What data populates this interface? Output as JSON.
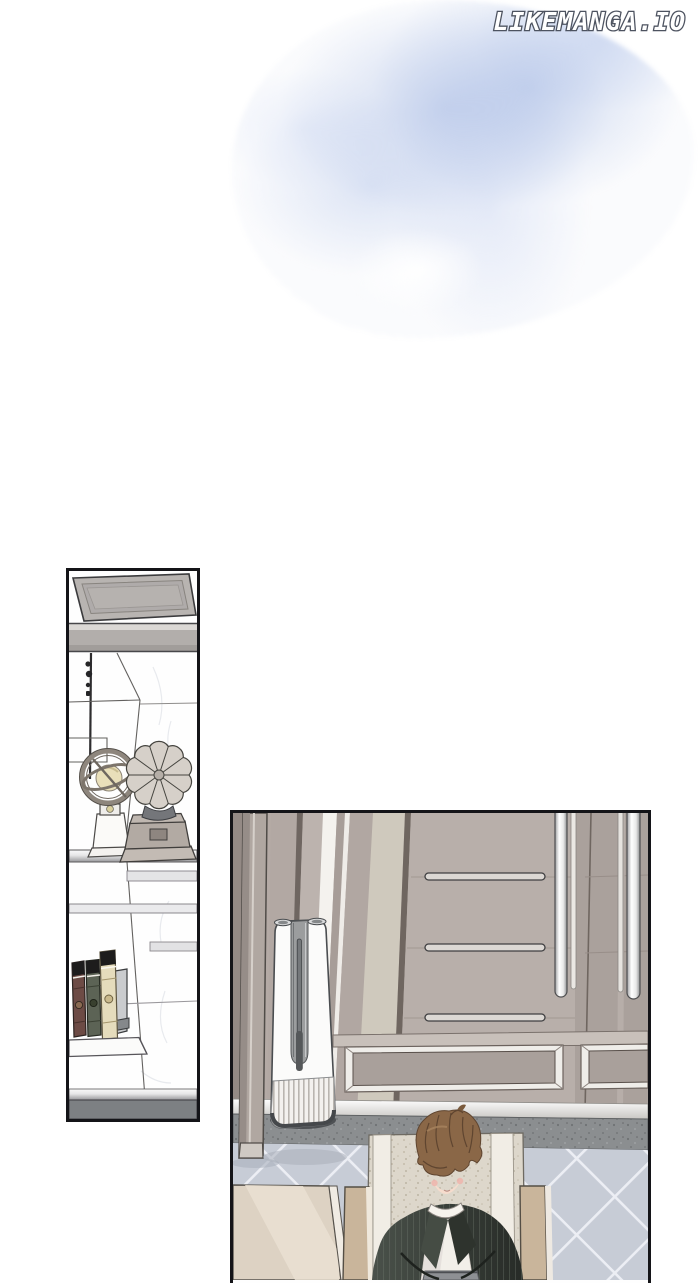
{
  "page": {
    "width": 700,
    "height": 1280,
    "background": "#ffffff"
  },
  "watermark": {
    "text": "LIKEMANGA.IO",
    "text_color": "#ffffff",
    "outline_color": "#4d5360"
  },
  "artwork": {
    "wash": {
      "type": "watercolor-texture",
      "position": "top-center",
      "colors": [
        "#a8bbe4",
        "#c7d3f0",
        "#ffffff"
      ]
    },
    "panels": [
      {
        "name": "bookshelf-panel",
        "border_color": "#141418",
        "items": [
          "cabinet-top-slab",
          "marble-shelves",
          "armillary-globe",
          "fan-ornament",
          "book-row",
          "bookend",
          "base-plinth"
        ],
        "palette": {
          "slab": "#b8b4b1",
          "shelf_silver": "#e8e8e8",
          "base_strip": "#7d8083",
          "book_spines": [
            "#6d4b45",
            "#5c6355",
            "#e5dcbc"
          ],
          "globe_sphere": "#e9dfba",
          "fan_body": "#d6d0c9"
        }
      },
      {
        "name": "room-panel",
        "border_color": "#141418",
        "items": [
          "wardrobe-doors",
          "door-handle-bars",
          "recessed-door-panels",
          "baseboard",
          "threshold-strip",
          "tiled-floor",
          "door-frame-pillar",
          "air-purifier-tower",
          "side-table",
          "armchair",
          "seated-man"
        ],
        "palette": {
          "door_taupe": "#b4aaa5",
          "door_light": "#bcb3ae",
          "door_cream": "#cfc9bd",
          "handle_white": "#ffffff",
          "baseboard": "#f5f4f1",
          "threshold": "#8b8e90",
          "floor_tile": "#c7ccd6",
          "purifier_white": "#fbfbfa",
          "table": "#ddd2c3",
          "armrest": "#c9b59b",
          "chair_back": "#ddd7cb",
          "jacket": "#3a403a",
          "shirt": "#f2efe9",
          "hair": "#8a6747",
          "skin": "#f6dccd",
          "pants": "#8e9094"
        }
      }
    ]
  }
}
